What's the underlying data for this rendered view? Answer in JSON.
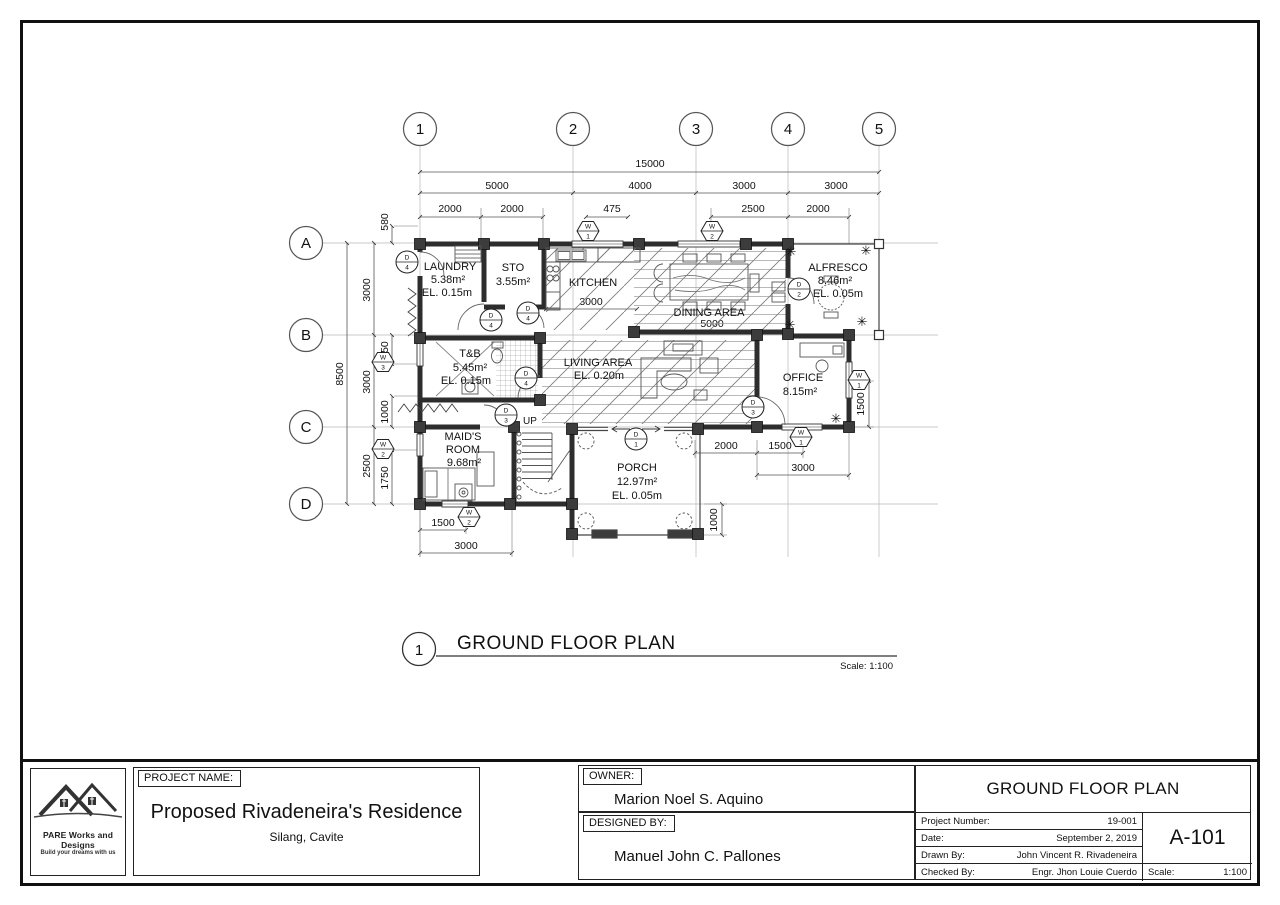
{
  "grid": {
    "cols": [
      "1",
      "2",
      "3",
      "4",
      "5"
    ],
    "rows": [
      "A",
      "B",
      "C",
      "D"
    ]
  },
  "dims": {
    "total_width": "15000",
    "top_spans": [
      "5000",
      "4000",
      "3000",
      "3000"
    ],
    "top_sub": [
      "2000",
      "2000",
      "475",
      "2500",
      "2000"
    ],
    "left_total": "8500",
    "left_spans": [
      "3000",
      "3000",
      "2500"
    ],
    "left_sub": [
      "580",
      "950",
      "1000",
      "1750"
    ],
    "kitchen_width": "3000",
    "dining_width": "5000",
    "office_side": "1500",
    "porch_top": [
      "2000",
      "1500"
    ],
    "office_bottom": "3000",
    "porch_side": "1000",
    "maid_bottom": [
      "1500",
      "3000"
    ]
  },
  "rooms": {
    "laundry": [
      "LAUNDRY",
      "5.38m²",
      "EL. 0.15m"
    ],
    "sto": [
      "STO",
      "3.55m²"
    ],
    "kitchen": [
      "KITCHEN"
    ],
    "dining": [
      "DINING AREA"
    ],
    "alfresco": [
      "ALFRESCO",
      "8.46m²",
      "EL. 0.05m"
    ],
    "tb": [
      "T&B",
      "5.45m²",
      "EL. 0.15m"
    ],
    "living": [
      "LIVING AREA",
      "EL. 0.20m"
    ],
    "office": [
      "OFFICE",
      "8.15m²"
    ],
    "maids": [
      "MAID'S",
      "ROOM",
      "9.68m²"
    ],
    "porch": [
      "PORCH",
      "12.97m²",
      "EL. 0.05m"
    ],
    "stair_up": "UP"
  },
  "symbols": {
    "door_letter": "D",
    "window_letter": "W",
    "doors": [
      "4",
      "4",
      "4",
      "4",
      "3",
      "3",
      "1",
      "2"
    ],
    "windows": [
      "1",
      "2",
      "3",
      "2",
      "2",
      "1",
      "1"
    ],
    "plant_glyph": "✳"
  },
  "drawing_title": {
    "number": "1",
    "title": "GROUND FLOOR PLAN",
    "scale": "Scale: 1:100"
  },
  "titleblock": {
    "company": "PARE Works and Designs",
    "tagline": "Build your dreams with us",
    "project_label": "PROJECT NAME:",
    "project_name": "Proposed Rivadeneira's Residence",
    "project_location": "Silang, Cavite",
    "owner_label": "OWNER:",
    "owner_name": "Marion Noel S. Aquino",
    "designed_label": "DESIGNED BY:",
    "designer_name": "Manuel John C. Pallones",
    "sheet_title": "GROUND FLOOR PLAN",
    "fields": [
      {
        "label": "Project Number:",
        "value": "19-001"
      },
      {
        "label": "Date:",
        "value": "September 2, 2019"
      },
      {
        "label": "Drawn By:",
        "value": "John Vincent R. Rivadeneira"
      },
      {
        "label": "Checked By:",
        "value": "Engr. Jhon Louie Cuerdo"
      }
    ],
    "sheet_number": "A-101",
    "scale_label": "Scale:",
    "scale_value": "1:100"
  }
}
